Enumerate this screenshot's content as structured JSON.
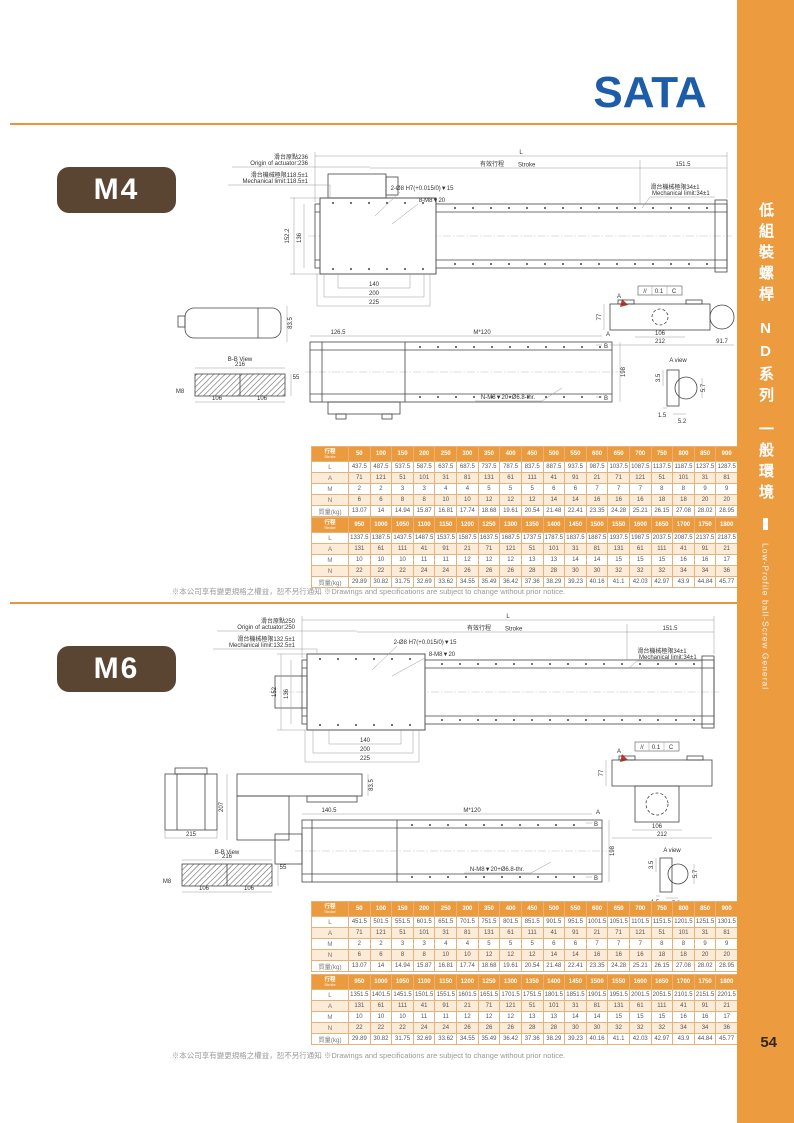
{
  "page": {
    "number": "54"
  },
  "header": {
    "logo_text": "SATA"
  },
  "sidebar": {
    "title_zh": "低組裝螺桿",
    "series_zh": "ND系列",
    "env_zh": "一般環境",
    "subtitle_en": "Low-Profile ball-Screw General"
  },
  "disclaimer_text": "※本公司享有變更規格之權益，恕不另行通知 ※Drawings and specifications are subject to change without prior notice.",
  "colors": {
    "accent_orange": "#EC9B3F",
    "badge_brown": "#5A4532",
    "logo_blue": "#1D5CA8",
    "view_cyan": "#29ABE2",
    "marker_red": "#D9352B"
  },
  "m4": {
    "model_label": "M4",
    "drawing": {
      "origin_zh": "滑台原點236",
      "origin_en": "Origin of actuator:236",
      "limit_left_zh": "滑台機械極限118.5±1",
      "limit_left_en": "Mechanical limit:118.5±1",
      "limit_right_zh": "滑台機械極限34±1",
      "limit_right_en": "Mechanical limit:34±1",
      "dim_total": "L",
      "stroke_zh": "有效行程",
      "stroke_en": "Stroke",
      "dim_right_end": "151.5",
      "callout_dowel": "2-Ø8 H7(+0.015/0)▼15",
      "callout_tap": "8-M8▼20",
      "dim_height_outer": "152.2",
      "dim_height_inner": "136",
      "dim_c1": "140",
      "dim_c2": "200",
      "dim_c3": "225",
      "dim_side_height": "83.5",
      "bb_title": "B-B View",
      "bb_width": "216",
      "bb_thick": "55",
      "bb_thread": "M8",
      "bb_half1": "106",
      "bb_half2": "106",
      "dim_bottom_lead": "126.5",
      "dim_pitch": "M*120",
      "dim_bottom_height": "198",
      "callout_bottom": "N-M8▼20+Ø6.8-thr.",
      "marker_a": "A",
      "marker_b": "B",
      "sec_h": "77",
      "sec_106": "106",
      "sec_212": "212",
      "sec_917": "91.7",
      "tol_sym": "//",
      "tol_val": "0.1",
      "tol_ref": "C",
      "aview_title": "A view",
      "av_35": "3.5",
      "av_57": "5.7",
      "av_15": "1.5",
      "av_52": "5.2"
    },
    "tables": [
      {
        "header": {
          "zh": "行程",
          "en": "Stroke"
        },
        "strokes": [
          "50",
          "100",
          "150",
          "200",
          "250",
          "300",
          "350",
          "400",
          "450",
          "500",
          "550",
          "600",
          "650",
          "700",
          "750",
          "800",
          "850",
          "900"
        ],
        "rows": [
          {
            "label": "L",
            "values": [
              "437.5",
              "487.5",
              "537.5",
              "587.5",
              "637.5",
              "687.5",
              "737.5",
              "787.5",
              "837.5",
              "887.5",
              "937.5",
              "987.5",
              "1037.5",
              "1087.5",
              "1137.5",
              "1187.5",
              "1237.5",
              "1287.5"
            ]
          },
          {
            "label": "A",
            "values": [
              "71",
              "121",
              "51",
              "101",
              "31",
              "81",
              "131",
              "61",
              "111",
              "41",
              "91",
              "21",
              "71",
              "121",
              "51",
              "101",
              "31",
              "81"
            ]
          },
          {
            "label": "M",
            "values": [
              "2",
              "2",
              "3",
              "3",
              "4",
              "4",
              "5",
              "5",
              "5",
              "6",
              "6",
              "7",
              "7",
              "7",
              "8",
              "8",
              "9",
              "9"
            ]
          },
          {
            "label": "N",
            "values": [
              "6",
              "6",
              "8",
              "8",
              "10",
              "10",
              "12",
              "12",
              "12",
              "14",
              "14",
              "16",
              "16",
              "16",
              "18",
              "18",
              "20",
              "20"
            ]
          },
          {
            "label": "質量(kg)",
            "values": [
              "13.07",
              "14",
              "14.94",
              "15.87",
              "16.81",
              "17.74",
              "18.68",
              "19.61",
              "20.54",
              "21.48",
              "22.41",
              "23.35",
              "24.28",
              "25.21",
              "26.15",
              "27.08",
              "28.02",
              "28.95"
            ]
          }
        ]
      },
      {
        "header": {
          "zh": "行程",
          "en": "Stroke"
        },
        "strokes": [
          "950",
          "1000",
          "1050",
          "1100",
          "1150",
          "1200",
          "1250",
          "1300",
          "1350",
          "1400",
          "1450",
          "1500",
          "1550",
          "1600",
          "1650",
          "1700",
          "1750",
          "1800"
        ],
        "rows": [
          {
            "label": "L",
            "values": [
              "1337.5",
              "1387.5",
              "1437.5",
              "1487.5",
              "1537.5",
              "1587.5",
              "1637.5",
              "1687.5",
              "1737.5",
              "1787.5",
              "1837.5",
              "1887.5",
              "1937.5",
              "1987.5",
              "2037.5",
              "2087.5",
              "2137.5",
              "2187.5"
            ]
          },
          {
            "label": "A",
            "values": [
              "131",
              "61",
              "111",
              "41",
              "91",
              "21",
              "71",
              "121",
              "51",
              "101",
              "31",
              "81",
              "131",
              "61",
              "111",
              "41",
              "91",
              "21"
            ]
          },
          {
            "label": "M",
            "values": [
              "10",
              "10",
              "10",
              "11",
              "11",
              "12",
              "12",
              "12",
              "13",
              "13",
              "14",
              "14",
              "15",
              "15",
              "15",
              "16",
              "16",
              "17"
            ]
          },
          {
            "label": "N",
            "values": [
              "22",
              "22",
              "22",
              "24",
              "24",
              "26",
              "26",
              "26",
              "28",
              "28",
              "30",
              "30",
              "32",
              "32",
              "32",
              "34",
              "34",
              "36"
            ]
          },
          {
            "label": "質量(kg)",
            "values": [
              "29.89",
              "30.82",
              "31.75",
              "32.69",
              "33.62",
              "34.55",
              "35.49",
              "36.42",
              "37.36",
              "38.29",
              "39.23",
              "40.16",
              "41.1",
              "42.03",
              "42.97",
              "43.9",
              "44.84",
              "45.77"
            ]
          }
        ]
      }
    ]
  },
  "m6": {
    "model_label": "M6",
    "drawing": {
      "origin_zh": "滑台原點250",
      "origin_en": "Origin of actuator:250",
      "limit_left_zh": "滑台機械極限132.5±1",
      "limit_left_en": "Mechanical limit:132.5±1",
      "limit_right_zh": "滑台機械極限34±1",
      "limit_right_en": "Mechanical limit:34±1",
      "dim_total": "L",
      "stroke_zh": "有效行程",
      "stroke_en": "Stroke",
      "dim_right_end": "151.5",
      "callout_dowel": "2-Ø8 H7(+0.015/0)▼15",
      "callout_tap": "8-M8▼20",
      "dim_height_outer": "152",
      "dim_height_inner": "136",
      "dim_c1": "140",
      "dim_c2": "200",
      "dim_c3": "225",
      "dim_front_width": "215",
      "dim_side_total": "207",
      "dim_side_height": "83.5",
      "bb_title": "B-B View",
      "bb_width": "216",
      "bb_thick": "55",
      "bb_thread": "M8",
      "bb_half1": "106",
      "bb_half2": "106",
      "dim_bottom_lead": "140.5",
      "dim_pitch": "M*120",
      "dim_bottom_height": "198",
      "callout_bottom": "N-M8▼20+Ø6.8-thr.",
      "marker_a": "A",
      "marker_b": "B",
      "sec_h": "77",
      "sec_106": "106",
      "sec_212": "212",
      "tol_sym": "//",
      "tol_val": "0.1",
      "tol_ref": "C",
      "aview_title": "A view",
      "av_35": "3.5",
      "av_57": "5.7",
      "av_15": "1.5",
      "av_52": "5.2"
    },
    "tables": [
      {
        "header": {
          "zh": "行程",
          "en": "Stroke"
        },
        "strokes": [
          "50",
          "100",
          "150",
          "200",
          "250",
          "300",
          "350",
          "400",
          "450",
          "500",
          "550",
          "600",
          "650",
          "700",
          "750",
          "800",
          "850",
          "900"
        ],
        "rows": [
          {
            "label": "L",
            "values": [
              "451.5",
              "501.5",
              "551.5",
              "601.5",
              "651.5",
              "701.5",
              "751.5",
              "801.5",
              "851.5",
              "901.5",
              "951.5",
              "1001.5",
              "1051.5",
              "1101.5",
              "1151.5",
              "1201.5",
              "1251.5",
              "1301.5"
            ]
          },
          {
            "label": "A",
            "values": [
              "71",
              "121",
              "51",
              "101",
              "31",
              "81",
              "131",
              "61",
              "111",
              "41",
              "91",
              "21",
              "71",
              "121",
              "51",
              "101",
              "31",
              "81"
            ]
          },
          {
            "label": "M",
            "values": [
              "2",
              "2",
              "3",
              "3",
              "4",
              "4",
              "5",
              "5",
              "5",
              "6",
              "6",
              "7",
              "7",
              "7",
              "8",
              "8",
              "9",
              "9"
            ]
          },
          {
            "label": "N",
            "values": [
              "6",
              "6",
              "8",
              "8",
              "10",
              "10",
              "12",
              "12",
              "12",
              "14",
              "14",
              "16",
              "16",
              "16",
              "18",
              "18",
              "20",
              "20"
            ]
          },
          {
            "label": "質量(kg)",
            "values": [
              "13.07",
              "14",
              "14.94",
              "15.87",
              "16.81",
              "17.74",
              "18.68",
              "19.61",
              "20.54",
              "21.48",
              "22.41",
              "23.35",
              "24.28",
              "25.21",
              "26.15",
              "27.08",
              "28.02",
              "28.95"
            ]
          }
        ]
      },
      {
        "header": {
          "zh": "行程",
          "en": "Stroke"
        },
        "strokes": [
          "950",
          "1000",
          "1050",
          "1100",
          "1150",
          "1200",
          "1250",
          "1300",
          "1350",
          "1400",
          "1450",
          "1500",
          "1550",
          "1600",
          "1650",
          "1700",
          "1750",
          "1800"
        ],
        "rows": [
          {
            "label": "L",
            "values": [
              "1351.5",
              "1401.5",
              "1451.5",
              "1501.5",
              "1551.5",
              "1601.5",
              "1651.5",
              "1701.5",
              "1751.5",
              "1801.5",
              "1851.5",
              "1901.5",
              "1951.5",
              "2001.5",
              "2051.5",
              "2101.5",
              "2151.5",
              "2201.5"
            ]
          },
          {
            "label": "A",
            "values": [
              "131",
              "61",
              "111",
              "41",
              "91",
              "21",
              "71",
              "121",
              "51",
              "101",
              "31",
              "81",
              "131",
              "61",
              "111",
              "41",
              "91",
              "21"
            ]
          },
          {
            "label": "M",
            "values": [
              "10",
              "10",
              "10",
              "11",
              "11",
              "12",
              "12",
              "12",
              "13",
              "13",
              "14",
              "14",
              "15",
              "15",
              "15",
              "16",
              "16",
              "17"
            ]
          },
          {
            "label": "N",
            "values": [
              "22",
              "22",
              "22",
              "24",
              "24",
              "26",
              "26",
              "26",
              "28",
              "28",
              "30",
              "30",
              "32",
              "32",
              "32",
              "34",
              "34",
              "36"
            ]
          },
          {
            "label": "質量(kg)",
            "values": [
              "29.89",
              "30.82",
              "31.75",
              "32.69",
              "33.62",
              "34.55",
              "35.49",
              "36.42",
              "37.36",
              "38.29",
              "39.23",
              "40.16",
              "41.1",
              "42.03",
              "42.97",
              "43.9",
              "44.84",
              "45.77"
            ]
          }
        ]
      }
    ]
  }
}
